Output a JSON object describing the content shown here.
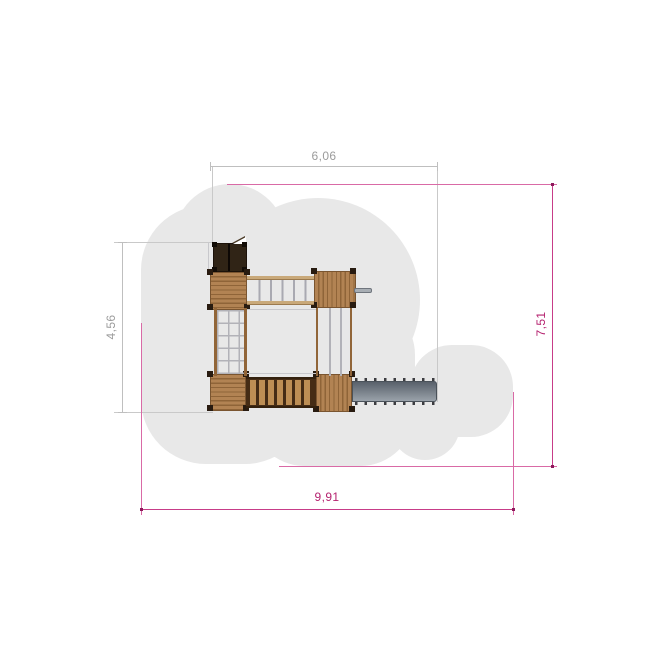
{
  "drawing": {
    "kind": "playground-structure-top-view-plan",
    "dimensions": {
      "top": {
        "label": "6,06"
      },
      "left": {
        "label": "4,56"
      },
      "right": {
        "label": "7,51"
      },
      "bottom": {
        "label": "9,91"
      }
    },
    "colors": {
      "safety_zone": "#e8e8e8",
      "dimension_gray_line": "#bfbfbf",
      "dimension_gray_text": "#9b9b9b",
      "dimension_magenta_line": "#c73c88",
      "dimension_magenta_text": "#b5226f",
      "wood": "#b28353",
      "wood_dark": "#452c15",
      "roof": "#302416",
      "slide_gray": "#7c848d"
    },
    "components": [
      "roof-tower",
      "platform-top-left",
      "platform-top-right",
      "platform-bottom-left",
      "platform-bottom-right",
      "monkey-bar-bridge",
      "climbing-net-ladder",
      "fireman-poles",
      "clatter-bridge",
      "slide",
      "grip-handle"
    ]
  }
}
